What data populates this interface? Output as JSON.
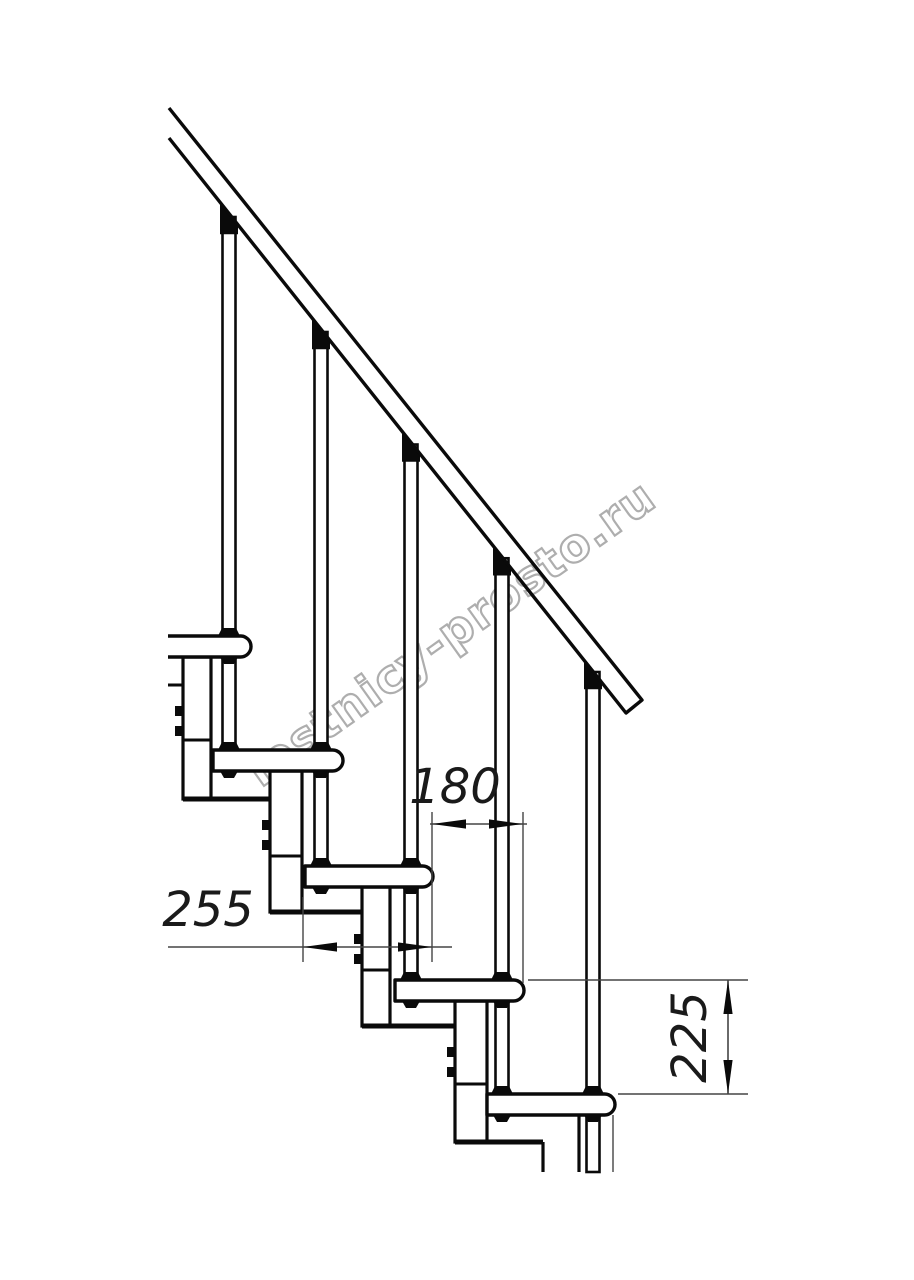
{
  "document": {
    "type": "technical-drawing",
    "subject": "Modular staircase side elevation with step dimensions"
  },
  "watermark": {
    "text": "lestnicy-prosto.ru"
  },
  "dimensions": {
    "step_run": {
      "value": "180",
      "orientation": "horizontal"
    },
    "tread_depth": {
      "value": "255",
      "orientation": "horizontal"
    },
    "step_rise": {
      "value": "225",
      "orientation": "vertical"
    }
  },
  "components": {
    "treads": 5,
    "balusters": 5,
    "support_modules": 5,
    "handrail": 1
  },
  "colors": {
    "line": "#0a0a0a",
    "dim_line": "#454545",
    "text": "#1a1a1a",
    "watermark": "#aeaeae",
    "background": "#ffffff"
  }
}
